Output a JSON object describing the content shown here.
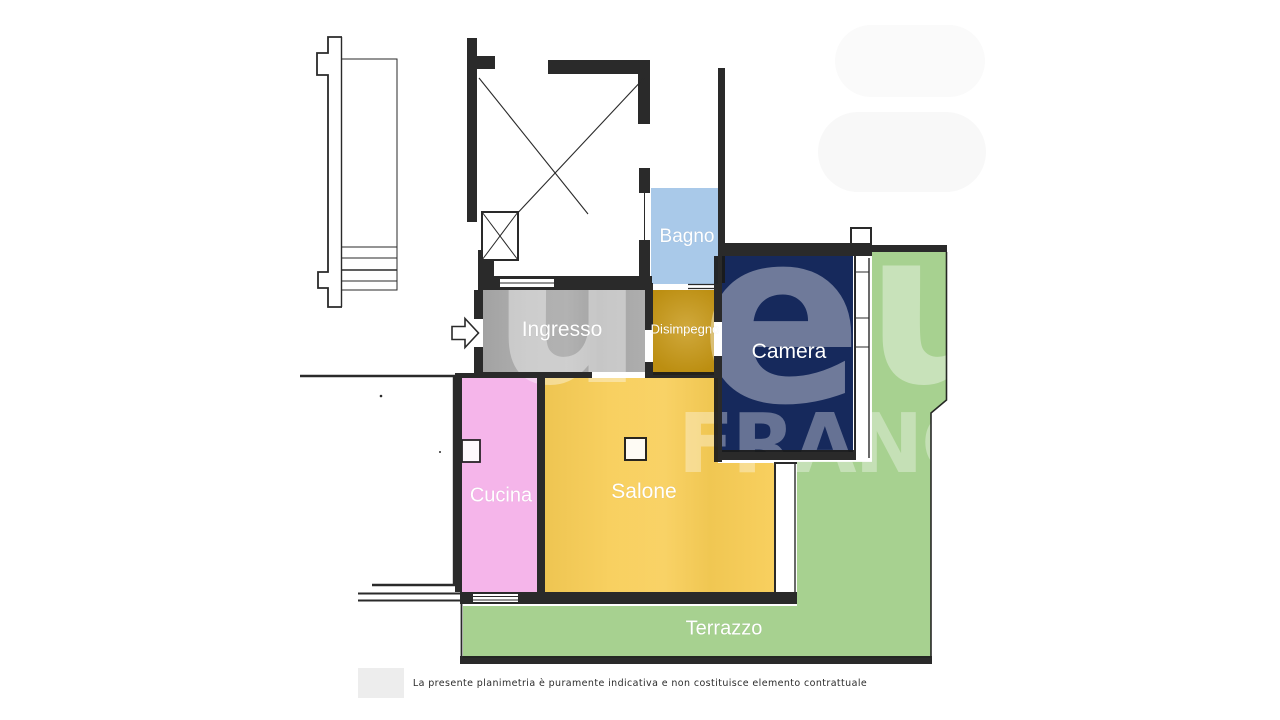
{
  "plan": {
    "wall_color": "#1a1a1a",
    "label_color": "#ffffff",
    "watermark_color": "#ffffff",
    "entrance_arrow": "right-arrow"
  },
  "rooms": [
    {
      "id": "bagno",
      "label": "Bagno",
      "color": "#a9c9e9"
    },
    {
      "id": "ingresso",
      "label": "Ingresso",
      "color": "#a9a9a9"
    },
    {
      "id": "disimpegno",
      "label": "Disimpegno",
      "color": "#c69612"
    },
    {
      "id": "camera",
      "label": "Camera",
      "color": "#16295c"
    },
    {
      "id": "cucina",
      "label": "Cucina",
      "color": "#f5b5ea"
    },
    {
      "id": "salone",
      "label": "Salone",
      "color": "#f8cd55"
    },
    {
      "id": "terrazzo",
      "label": "Terrazzo",
      "color": "#a7d190"
    }
  ],
  "watermark": {
    "letters": [
      "u",
      "e",
      "u"
    ],
    "brand_fragment": "FRANCH"
  },
  "footer": {
    "disclaimer": "La presente planimetria è puramente indicativa e non costituisce elemento contrattuale"
  }
}
